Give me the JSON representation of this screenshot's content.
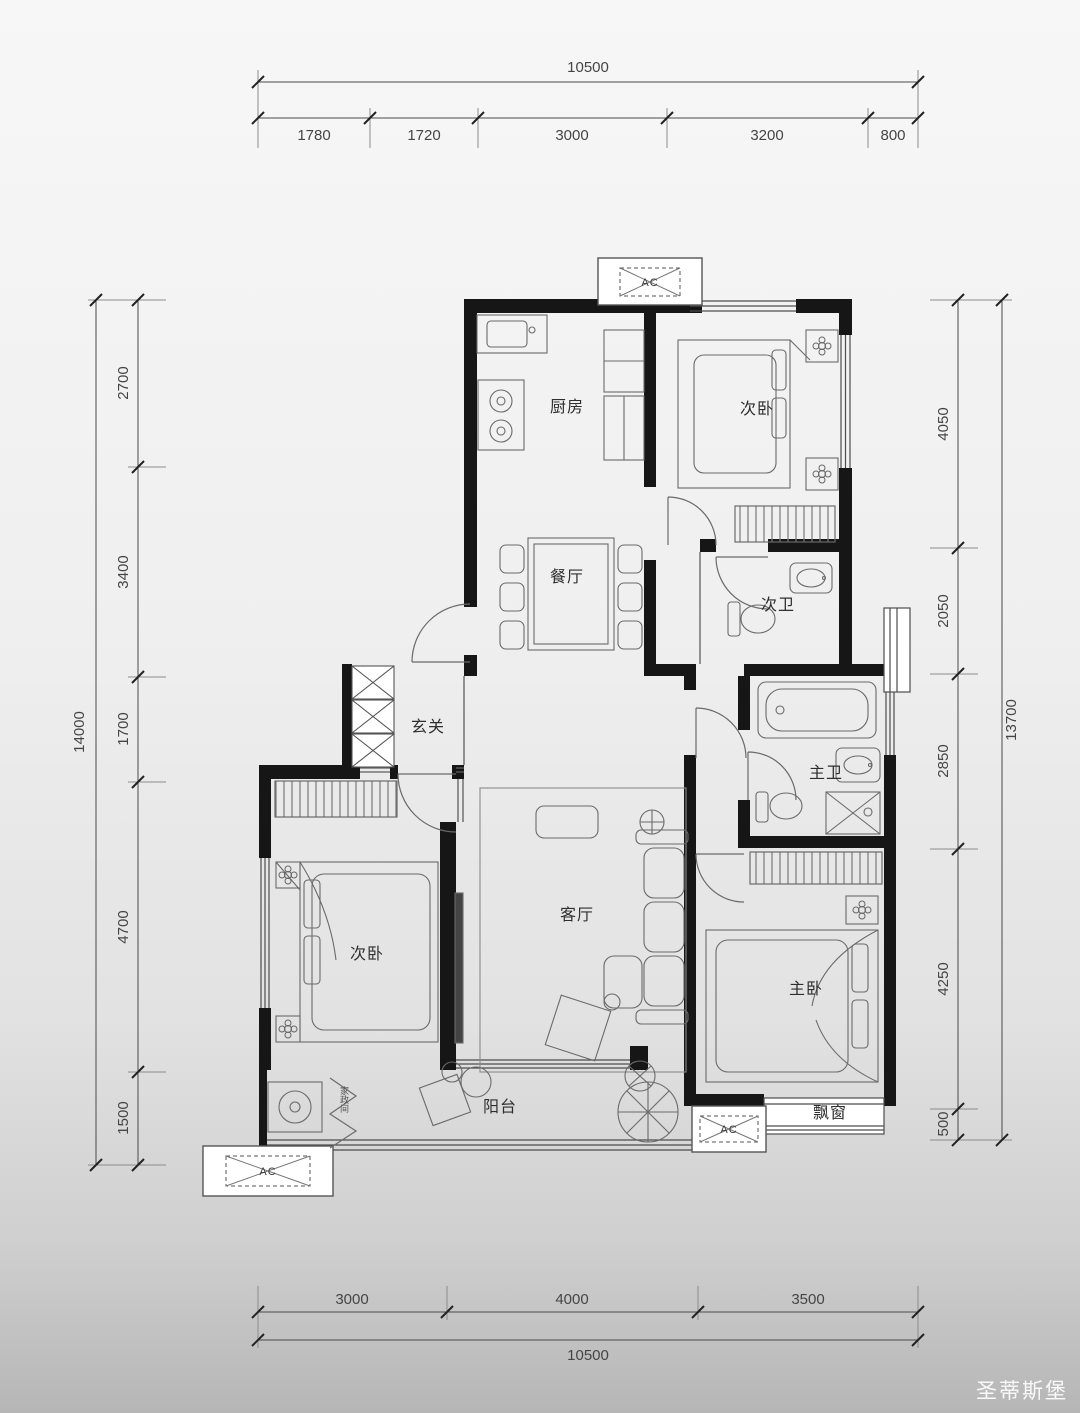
{
  "plan": {
    "rooms": {
      "kitchen": "厨房",
      "bedroom2_top": "次卧",
      "bath2": "次卫",
      "dining": "餐厅",
      "foyer": "玄关",
      "living": "客厅",
      "bedroom2_left": "次卧",
      "bath_master": "主卫",
      "bedroom_master": "主卧",
      "balcony": "阳台",
      "bay_window": "飘窗",
      "laundry": "家政间"
    },
    "ac_label": "AC",
    "dims": {
      "top": {
        "total": "10500",
        "segs": [
          "1780",
          "1720",
          "3000",
          "3200",
          "800"
        ]
      },
      "bottom": {
        "total": "10500",
        "segs": [
          "3000",
          "4000",
          "3500"
        ]
      },
      "left": {
        "total": "14000",
        "segs": [
          "2700",
          "3400",
          "1700",
          "4700",
          "1500"
        ]
      },
      "right": {
        "total": "13700",
        "segs": [
          "4050",
          "2050",
          "2850",
          "4250",
          "500"
        ]
      }
    },
    "watermark": "圣蒂斯堡"
  }
}
